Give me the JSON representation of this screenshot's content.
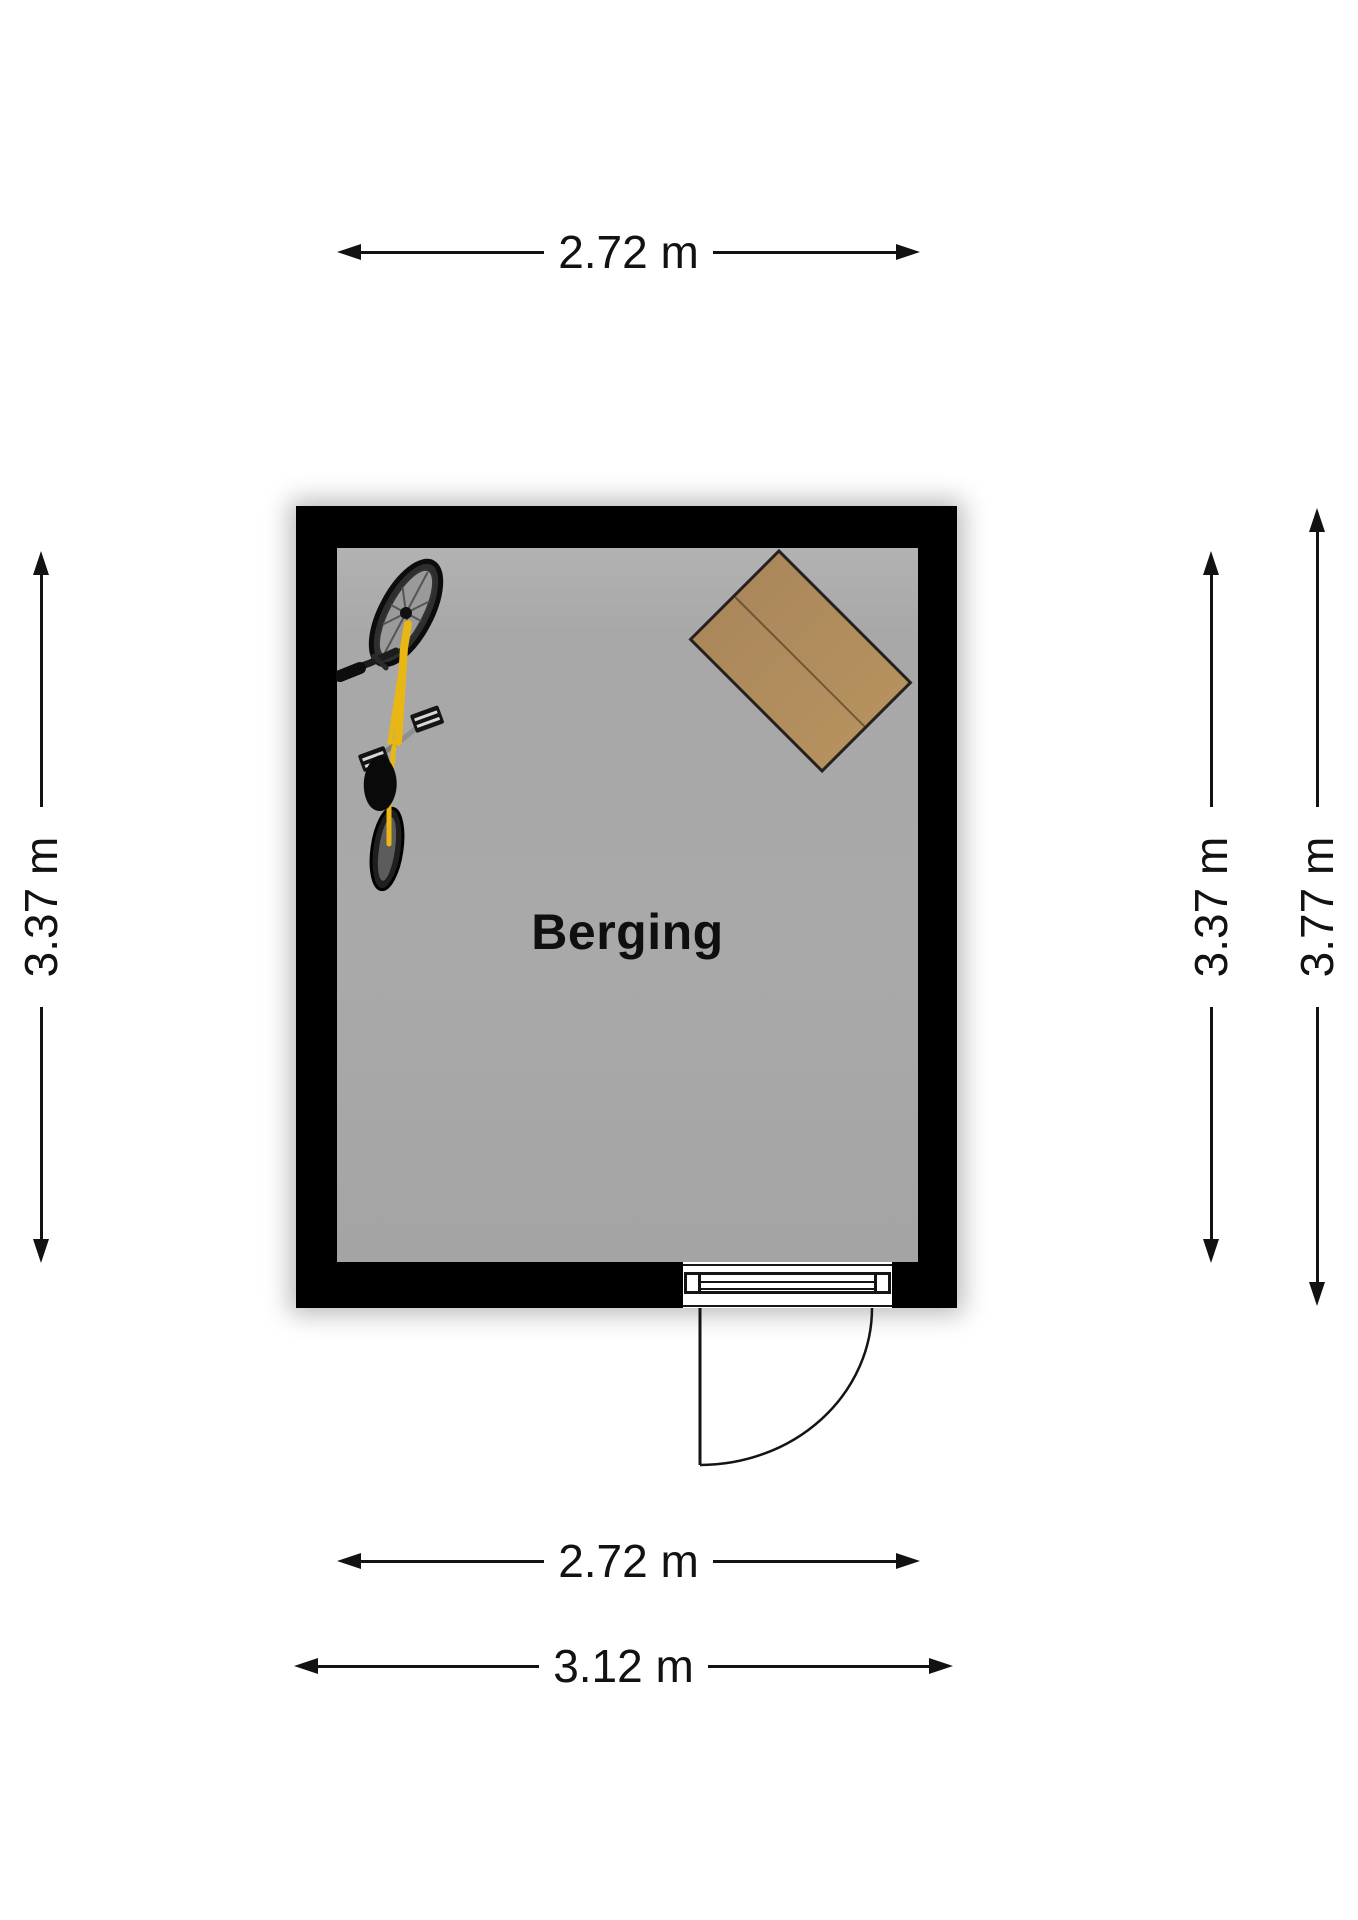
{
  "room": {
    "label": "Berging",
    "floor_color": "#a9a9a9",
    "wall_color": "#000000"
  },
  "dimensions": {
    "top_width": "2.72 m",
    "left_height": "3.37 m",
    "right_inner_height": "3.37 m",
    "right_outer_height": "3.77 m",
    "bottom_inner_width": "2.72 m",
    "bottom_outer_width": "3.12 m"
  },
  "furniture": {
    "table": {
      "name": "table",
      "color": "#b08c5c"
    },
    "bicycle": {
      "name": "bicycle",
      "frame_color": "#e8b713"
    }
  },
  "door": {
    "type": "swing-door",
    "position": "bottom"
  }
}
